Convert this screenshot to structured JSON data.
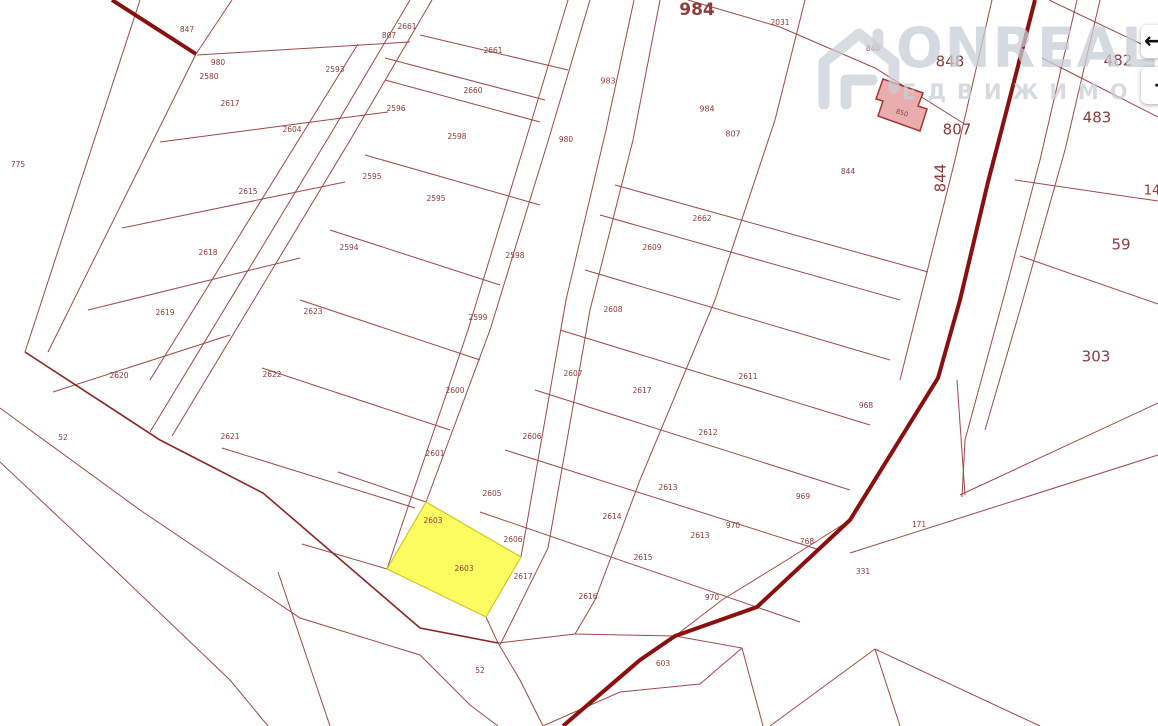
{
  "watermark": {
    "brand": "ONREALT",
    "subtitle": "ЕДВИЖИМО"
  },
  "buttons": {
    "prev_icon": "←",
    "next_icon": "→"
  },
  "map": {
    "background": "#ffffff",
    "line_color": "#a04848",
    "road_color": "#8a1010",
    "label_color": "#8e3a3a",
    "roads": [
      [
        [
          112,
          0
        ],
        [
          196,
          54
        ]
      ],
      [
        [
          1035,
          0
        ],
        [
          1008,
          105
        ],
        [
          988,
          182
        ],
        [
          960,
          300
        ],
        [
          938,
          378
        ],
        [
          850,
          520
        ],
        [
          757,
          607
        ],
        [
          675,
          636
        ],
        [
          640,
          660
        ],
        [
          563,
          726
        ]
      ]
    ],
    "band_lines": [
      [
        [
          25,
          352
        ],
        [
          160,
          440
        ],
        [
          263,
          493
        ],
        [
          420,
          628
        ],
        [
          498,
          643
        ]
      ]
    ],
    "thin_lines": [
      [
        [
          140,
          0
        ],
        [
          25,
          352
        ]
      ],
      [
        [
          196,
          54
        ],
        [
          48,
          352
        ]
      ],
      [
        [
          232,
          0
        ],
        [
          196,
          54
        ]
      ],
      [
        [
          0,
          408
        ],
        [
          140,
          510
        ],
        [
          300,
          618
        ],
        [
          420,
          655
        ],
        [
          470,
          705
        ],
        [
          498,
          726
        ]
      ],
      [
        [
          0,
          462
        ],
        [
          117,
          572
        ],
        [
          230,
          680
        ],
        [
          268,
          726
        ]
      ],
      [
        [
          197,
          55
        ],
        [
          410,
          42
        ]
      ],
      [
        [
          160,
          142
        ],
        [
          388,
          112
        ]
      ],
      [
        [
          122,
          228
        ],
        [
          345,
          182
        ]
      ],
      [
        [
          88,
          310
        ],
        [
          300,
          258
        ]
      ],
      [
        [
          53,
          392
        ],
        [
          230,
          335
        ]
      ],
      [
        [
          358,
          44
        ],
        [
          150,
          380
        ]
      ],
      [
        [
          410,
          0
        ],
        [
          330,
          135
        ],
        [
          150,
          432
        ]
      ],
      [
        [
          432,
          0
        ],
        [
          352,
          137
        ],
        [
          172,
          436
        ]
      ],
      [
        [
          568,
          0
        ],
        [
          527,
          136
        ],
        [
          468,
          330
        ],
        [
          387,
          569
        ]
      ],
      [
        [
          590,
          0
        ],
        [
          549,
          138
        ],
        [
          490,
          330
        ],
        [
          426,
          502
        ]
      ],
      [
        [
          634,
          0
        ],
        [
          606,
          130
        ],
        [
          566,
          300
        ],
        [
          521,
          557
        ]
      ],
      [
        [
          660,
          0
        ],
        [
          633,
          140
        ],
        [
          590,
          310
        ],
        [
          548,
          548
        ],
        [
          500,
          645
        ]
      ],
      [
        [
          805,
          0
        ],
        [
          775,
          120
        ],
        [
          715,
          300
        ],
        [
          640,
          480
        ],
        [
          595,
          600
        ]
      ],
      [
        [
          420,
          35
        ],
        [
          568,
          70
        ]
      ],
      [
        [
          385,
          58
        ],
        [
          545,
          100
        ]
      ],
      [
        [
          385,
          80
        ],
        [
          540,
          122
        ]
      ],
      [
        [
          365,
          155
        ],
        [
          540,
          205
        ]
      ],
      [
        [
          330,
          230
        ],
        [
          500,
          285
        ]
      ],
      [
        [
          300,
          300
        ],
        [
          480,
          360
        ]
      ],
      [
        [
          262,
          368
        ],
        [
          450,
          430
        ]
      ],
      [
        [
          222,
          448
        ],
        [
          415,
          508
        ]
      ],
      [
        [
          688,
          0
        ],
        [
          780,
          27
        ],
        [
          875,
          68
        ],
        [
          963,
          123
        ]
      ],
      [
        [
          615,
          185
        ],
        [
          928,
          272
        ]
      ],
      [
        [
          600,
          215
        ],
        [
          900,
          300
        ]
      ],
      [
        [
          585,
          270
        ],
        [
          890,
          360
        ]
      ],
      [
        [
          560,
          330
        ],
        [
          870,
          425
        ]
      ],
      [
        [
          535,
          390
        ],
        [
          850,
          490
        ]
      ],
      [
        [
          505,
          450
        ],
        [
          820,
          550
        ]
      ],
      [
        [
          480,
          512
        ],
        [
          800,
          622
        ]
      ],
      [
        [
          595,
          600
        ],
        [
          575,
          634
        ]
      ],
      [
        [
          575,
          634
        ],
        [
          675,
          636
        ]
      ],
      [
        [
          498,
          643
        ],
        [
          575,
          634
        ]
      ],
      [
        [
          498,
          643
        ],
        [
          520,
          680
        ],
        [
          543,
          726
        ]
      ],
      [
        [
          675,
          636
        ],
        [
          742,
          648
        ],
        [
          763,
          726
        ]
      ],
      [
        [
          543,
          726
        ],
        [
          620,
          692
        ],
        [
          700,
          684
        ],
        [
          742,
          648
        ]
      ],
      [
        [
          675,
          636
        ],
        [
          722,
          600
        ],
        [
          790,
          558
        ],
        [
          850,
          520
        ]
      ],
      [
        [
          486,
          617
        ],
        [
          498,
          643
        ]
      ],
      [
        [
          426,
          502
        ],
        [
          338,
          472
        ]
      ],
      [
        [
          387,
          569
        ],
        [
          302,
          544
        ]
      ],
      [
        [
          278,
          572
        ],
        [
          330,
          726
        ]
      ],
      [
        [
          960,
          495
        ],
        [
          1158,
          403
        ]
      ],
      [
        [
          850,
          553
        ],
        [
          1158,
          455
        ]
      ],
      [
        [
          957,
          380
        ],
        [
          965,
          495
        ]
      ],
      [
        [
          875,
          649
        ],
        [
          900,
          726
        ]
      ],
      [
        [
          875,
          649
        ],
        [
          1040,
          726
        ]
      ],
      [
        [
          770,
          726
        ],
        [
          875,
          649
        ]
      ],
      [
        [
          1049,
          0
        ],
        [
          1158,
          52
        ]
      ],
      [
        [
          1042,
          58
        ],
        [
          1158,
          117
        ]
      ],
      [
        [
          1015,
          180
        ],
        [
          1158,
          201
        ]
      ],
      [
        [
          1020,
          256
        ],
        [
          1158,
          304
        ]
      ],
      [
        [
          992,
          0
        ],
        [
          955,
          160
        ],
        [
          920,
          300
        ],
        [
          900,
          380
        ]
      ],
      [
        [
          1077,
          0
        ],
        [
          1040,
          160
        ],
        [
          1003,
          300
        ],
        [
          965,
          440
        ],
        [
          962,
          497
        ]
      ],
      [
        [
          1100,
          0
        ],
        [
          1065,
          150
        ],
        [
          1020,
          310
        ],
        [
          985,
          430
        ]
      ]
    ],
    "highlight_parcel": {
      "id": "2603",
      "fill": "#FCFC60",
      "stroke": "#c9c92c",
      "points": [
        [
          426,
          502
        ],
        [
          521,
          557
        ],
        [
          486,
          617
        ],
        [
          387,
          569
        ]
      ],
      "labels": [
        {
          "t": "2603",
          "x": 433,
          "y": 521
        },
        {
          "t": "2603",
          "x": 464,
          "y": 569
        }
      ]
    },
    "building": {
      "id": "850",
      "fill": "#EAADAD",
      "stroke": "#A83232",
      "points": [
        [
          883,
          79
        ],
        [
          923,
          93
        ],
        [
          918,
          106
        ],
        [
          927,
          109
        ],
        [
          920,
          131
        ],
        [
          878,
          116
        ],
        [
          883,
          101
        ],
        [
          876,
          99
        ]
      ],
      "label": {
        "t": "850",
        "x": 902,
        "y": 113,
        "s": 6.5,
        "r": 18,
        "c": "#ffffff"
      }
    },
    "labels": [
      {
        "t": "775",
        "x": 18,
        "y": 165
      },
      {
        "t": "847",
        "x": 187,
        "y": 30
      },
      {
        "t": "980",
        "x": 218,
        "y": 63
      },
      {
        "t": "2580",
        "x": 209,
        "y": 77
      },
      {
        "t": "2617",
        "x": 230,
        "y": 104
      },
      {
        "t": "2593",
        "x": 335,
        "y": 70
      },
      {
        "t": "2604",
        "x": 292,
        "y": 130
      },
      {
        "t": "2615",
        "x": 248,
        "y": 192
      },
      {
        "t": "2595",
        "x": 372,
        "y": 177
      },
      {
        "t": "2594",
        "x": 349,
        "y": 248
      },
      {
        "t": "2618",
        "x": 208,
        "y": 253
      },
      {
        "t": "2619",
        "x": 165,
        "y": 313
      },
      {
        "t": "2620",
        "x": 119,
        "y": 376
      },
      {
        "t": "52",
        "x": 63,
        "y": 438
      },
      {
        "t": "2623",
        "x": 313,
        "y": 312
      },
      {
        "t": "2622",
        "x": 272,
        "y": 375
      },
      {
        "t": "2621",
        "x": 230,
        "y": 437
      },
      {
        "t": "807",
        "x": 389,
        "y": 36
      },
      {
        "t": "2661",
        "x": 407,
        "y": 27
      },
      {
        "t": "2661",
        "x": 493,
        "y": 51
      },
      {
        "t": "2660",
        "x": 473,
        "y": 91
      },
      {
        "t": "2596",
        "x": 396,
        "y": 109
      },
      {
        "t": "2598",
        "x": 457,
        "y": 137
      },
      {
        "t": "2595",
        "x": 436,
        "y": 199
      },
      {
        "t": "2598",
        "x": 515,
        "y": 256
      },
      {
        "t": "2599",
        "x": 478,
        "y": 318
      },
      {
        "t": "2600",
        "x": 455,
        "y": 391
      },
      {
        "t": "2601",
        "x": 435,
        "y": 454
      },
      {
        "t": "2607",
        "x": 573,
        "y": 374
      },
      {
        "t": "2606",
        "x": 532,
        "y": 437
      },
      {
        "t": "2605",
        "x": 492,
        "y": 494
      },
      {
        "t": "2606",
        "x": 513,
        "y": 540
      },
      {
        "t": "2617",
        "x": 523,
        "y": 577
      },
      {
        "t": "983",
        "x": 608,
        "y": 81,
        "s": 8
      },
      {
        "t": "984",
        "x": 707,
        "y": 109,
        "s": 8
      },
      {
        "t": "807",
        "x": 733,
        "y": 134,
        "s": 8
      },
      {
        "t": "980",
        "x": 566,
        "y": 140
      },
      {
        "t": "2031",
        "x": 780,
        "y": 23
      },
      {
        "t": "848",
        "x": 873,
        "y": 49
      },
      {
        "t": "844",
        "x": 848,
        "y": 172
      },
      {
        "t": "2662",
        "x": 702,
        "y": 219
      },
      {
        "t": "2609",
        "x": 652,
        "y": 248
      },
      {
        "t": "2608",
        "x": 613,
        "y": 310
      },
      {
        "t": "2617",
        "x": 642,
        "y": 391
      },
      {
        "t": "2611",
        "x": 748,
        "y": 377
      },
      {
        "t": "2612",
        "x": 708,
        "y": 433
      },
      {
        "t": "2613",
        "x": 668,
        "y": 488
      },
      {
        "t": "2614",
        "x": 612,
        "y": 517
      },
      {
        "t": "2615",
        "x": 643,
        "y": 558
      },
      {
        "t": "2616",
        "x": 588,
        "y": 597
      },
      {
        "t": "2613",
        "x": 700,
        "y": 536
      },
      {
        "t": "970",
        "x": 733,
        "y": 526
      },
      {
        "t": "969",
        "x": 803,
        "y": 497
      },
      {
        "t": "768",
        "x": 807,
        "y": 542
      },
      {
        "t": "970",
        "x": 712,
        "y": 598
      },
      {
        "t": "968",
        "x": 866,
        "y": 406
      },
      {
        "t": "171",
        "x": 919,
        "y": 525
      },
      {
        "t": "331",
        "x": 863,
        "y": 572
      },
      {
        "t": "603",
        "x": 663,
        "y": 664
      },
      {
        "t": "52",
        "x": 480,
        "y": 671
      },
      {
        "t": "984",
        "x": 697,
        "y": 10,
        "s": 17,
        "b": true
      },
      {
        "t": "848",
        "x": 950,
        "y": 62,
        "s": 15
      },
      {
        "t": "807",
        "x": 957,
        "y": 130,
        "s": 15
      },
      {
        "t": "844",
        "x": 941,
        "y": 178,
        "s": 15,
        "r": -90
      },
      {
        "t": "482",
        "x": 1118,
        "y": 61,
        "s": 15
      },
      {
        "t": "483",
        "x": 1097,
        "y": 118,
        "s": 15
      },
      {
        "t": "59",
        "x": 1121,
        "y": 245,
        "s": 15
      },
      {
        "t": "303",
        "x": 1096,
        "y": 357,
        "s": 15
      },
      {
        "t": "14",
        "x": 1152,
        "y": 191,
        "s": 13
      }
    ]
  }
}
